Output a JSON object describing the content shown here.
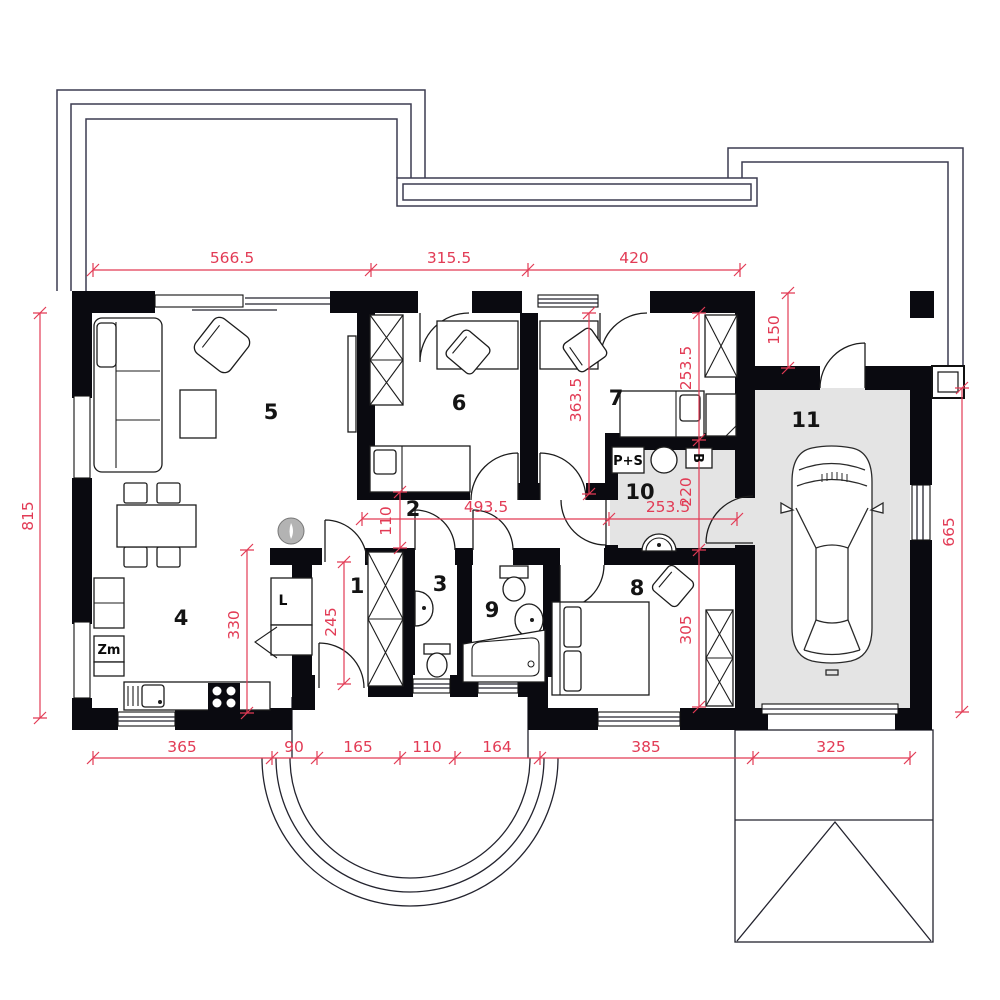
{
  "plan_title": "Single-storey house floor plan with garage",
  "rooms": {
    "r1": "1",
    "r2": "2",
    "r3": "3",
    "r4": "4",
    "r5": "5",
    "r6": "6",
    "r7": "7",
    "r8": "8",
    "r9": "9",
    "r10": "10",
    "r11": "11"
  },
  "labels": {
    "washer_dryer": "P+S",
    "boiler": "B",
    "freezer": "Zm",
    "fridge": "L"
  },
  "dims": {
    "top1": "566.5",
    "top2": "315.5",
    "top3": "420",
    "left": "815",
    "right": "665",
    "bottom1": "365",
    "bottom2": "90",
    "bottom3": "165",
    "bottom4": "110",
    "bottom5": "164",
    "bottom6": "385",
    "bottom7": "325",
    "garage_entry": "150",
    "hall_top": "253.5",
    "boiler_room": "220",
    "bedroom_mid": "363.5",
    "corridor": "493.5",
    "utility": "253.5",
    "corridor_width": "110",
    "hall_height": "245",
    "kitchen": "330",
    "bedroom8": "305"
  },
  "colors": {
    "dimension": "#e23b55",
    "wall": "#0a0a10",
    "floor_gray": "#e4e4e4"
  }
}
